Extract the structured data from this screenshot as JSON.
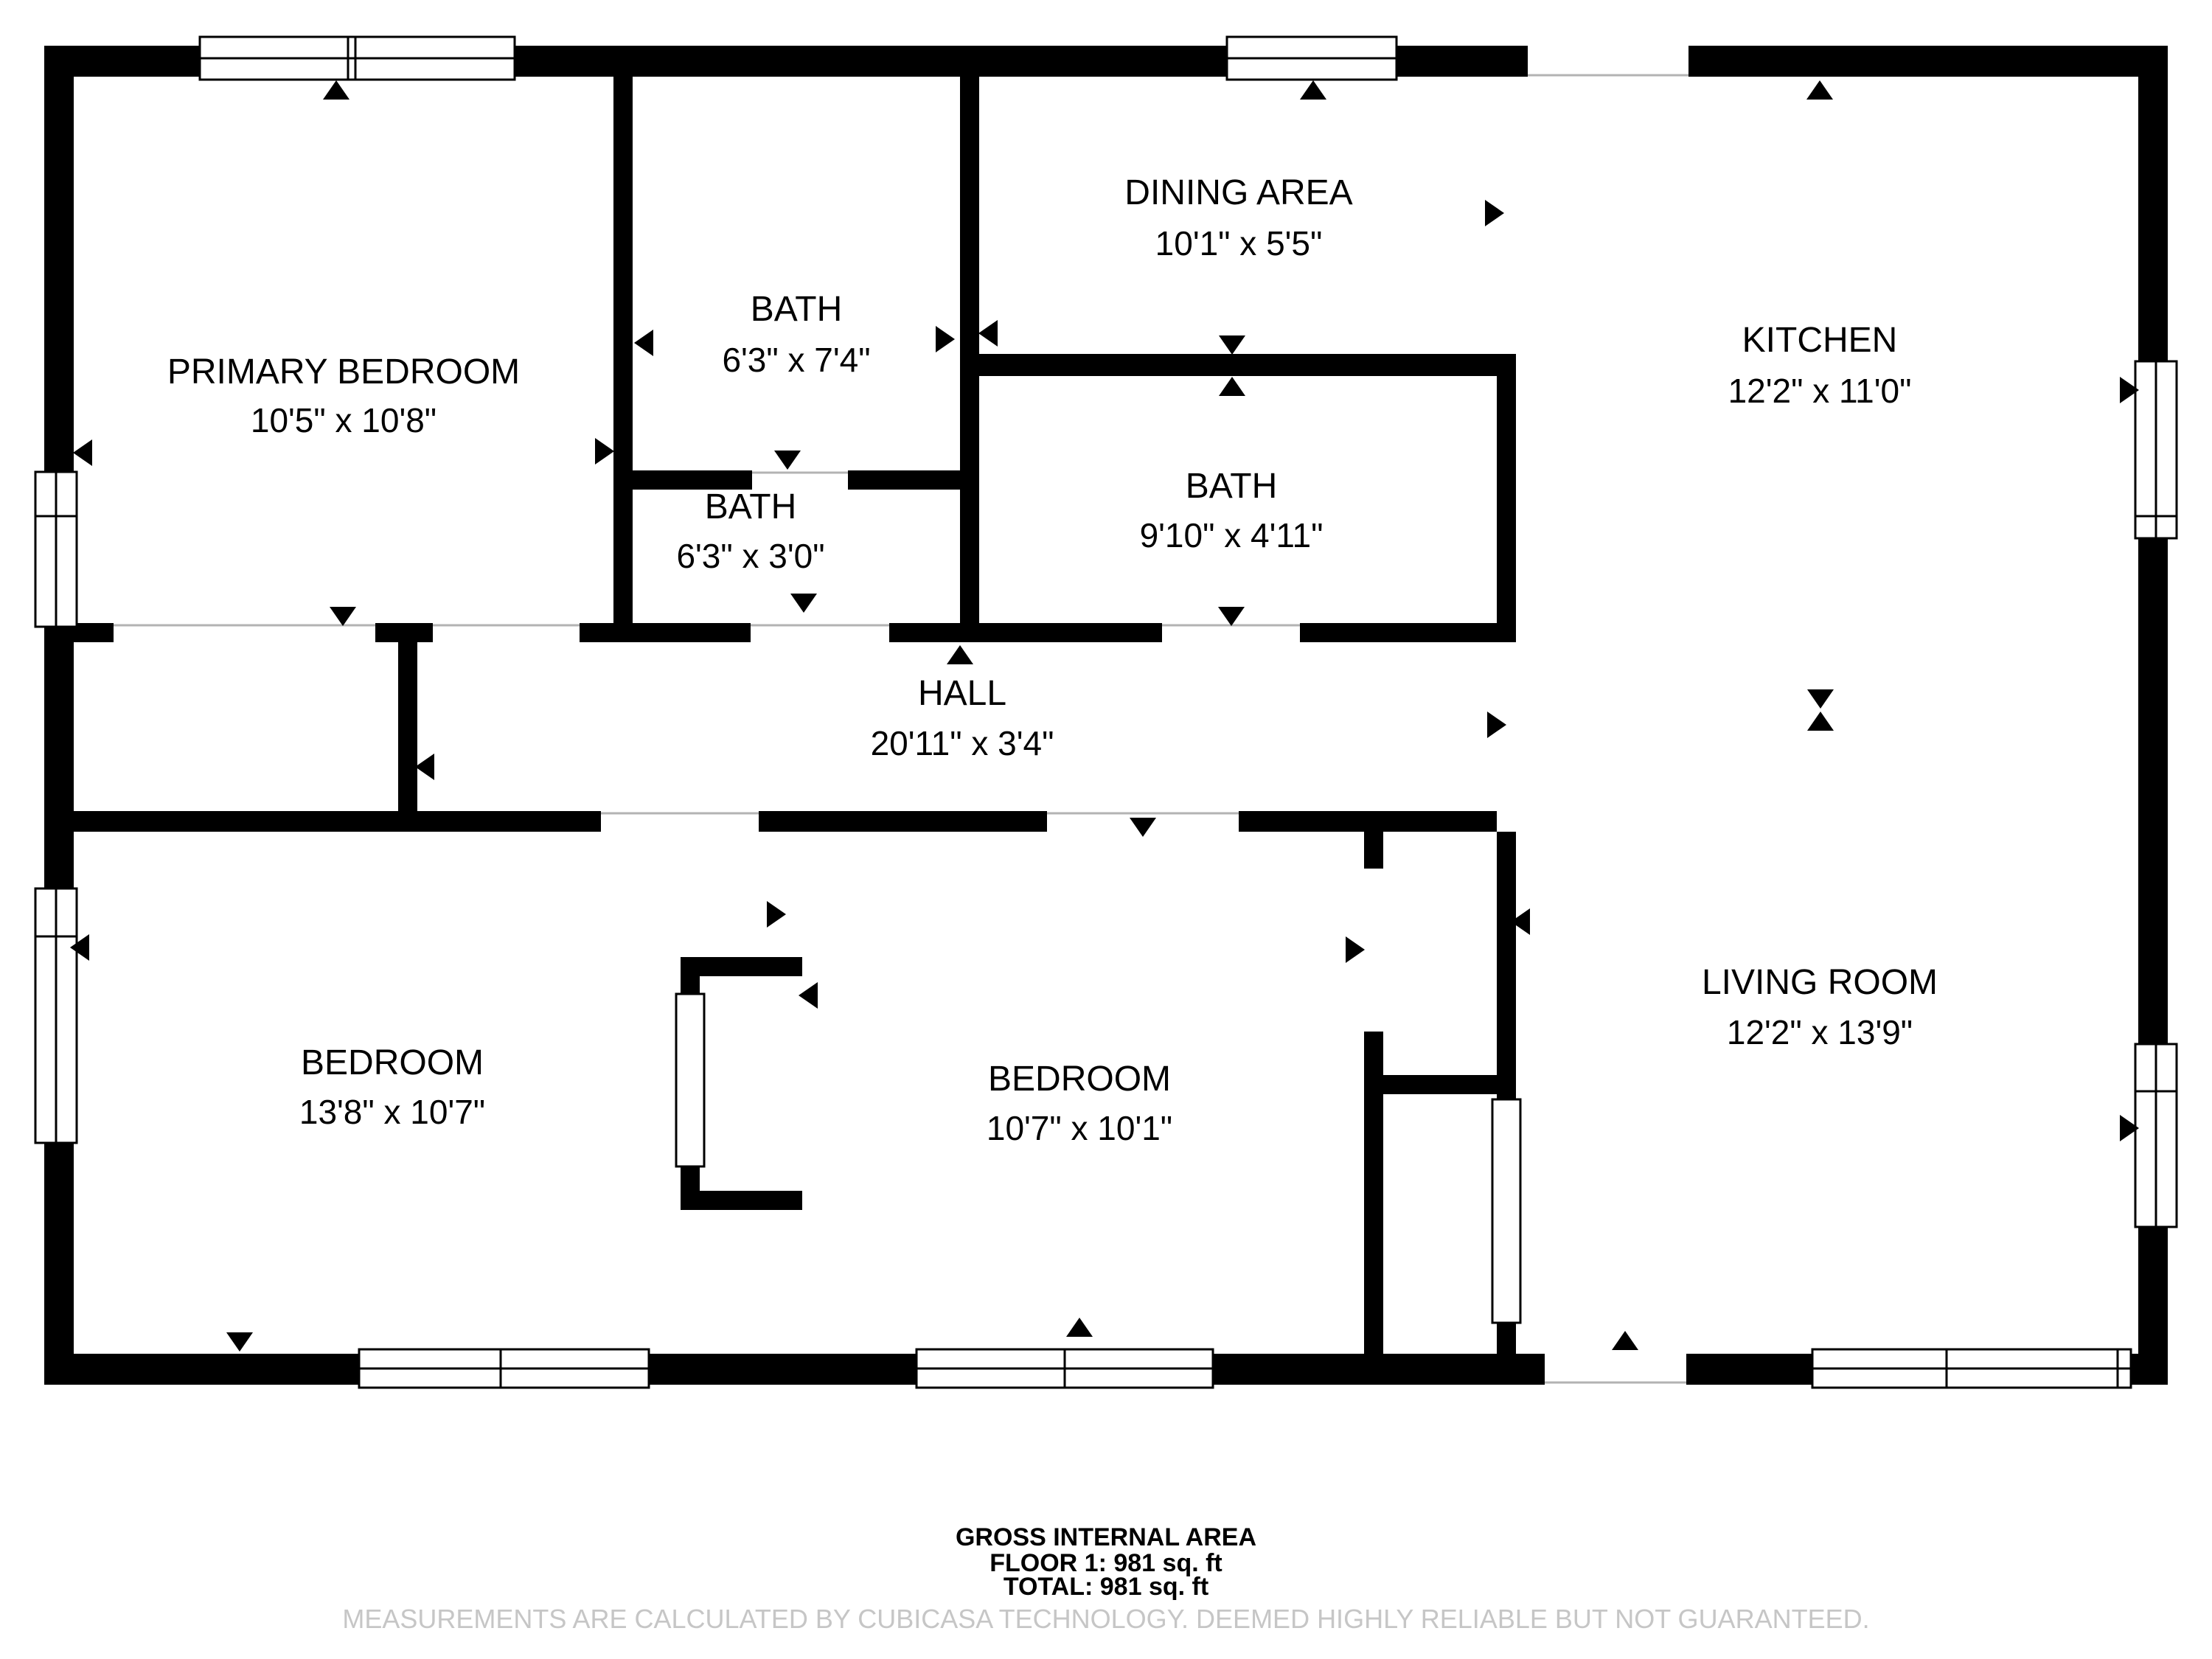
{
  "floorplan": {
    "rooms": [
      {
        "name": "PRIMARY BEDROOM",
        "dims": "10'5\" x 10'8\""
      },
      {
        "name": "BATH",
        "dims": "6'3\" x 7'4\""
      },
      {
        "name": "DINING AREA",
        "dims": "10'1\" x 5'5\""
      },
      {
        "name": "KITCHEN",
        "dims": "12'2\" x 11'0\""
      },
      {
        "name": "BATH",
        "dims": "6'3\" x 3'0\""
      },
      {
        "name": "BATH",
        "dims": "9'10\" x 4'11\""
      },
      {
        "name": "HALL",
        "dims": "20'11\" x 3'4\""
      },
      {
        "name": "BEDROOM",
        "dims": "13'8\" x 10'7\""
      },
      {
        "name": "BEDROOM",
        "dims": "10'7\" x 10'1\""
      },
      {
        "name": "LIVING ROOM",
        "dims": "12'2\" x 13'9\""
      }
    ],
    "footer": {
      "gross_label": "GROSS INTERNAL AREA",
      "floor_line": "FLOOR 1: 981 sq. ft",
      "total_line": "TOTAL: 981 sq. ft",
      "disclaimer": "MEASUREMENTS ARE CALCULATED BY CUBICASA TECHNOLOGY. DEEMED HIGHLY RELIABLE BUT NOT GUARANTEED."
    },
    "colors": {
      "wall": "#000000",
      "background": "#ffffff",
      "threshold": "#b3b3b3",
      "disclaimer_text": "#c6c6c6"
    }
  }
}
